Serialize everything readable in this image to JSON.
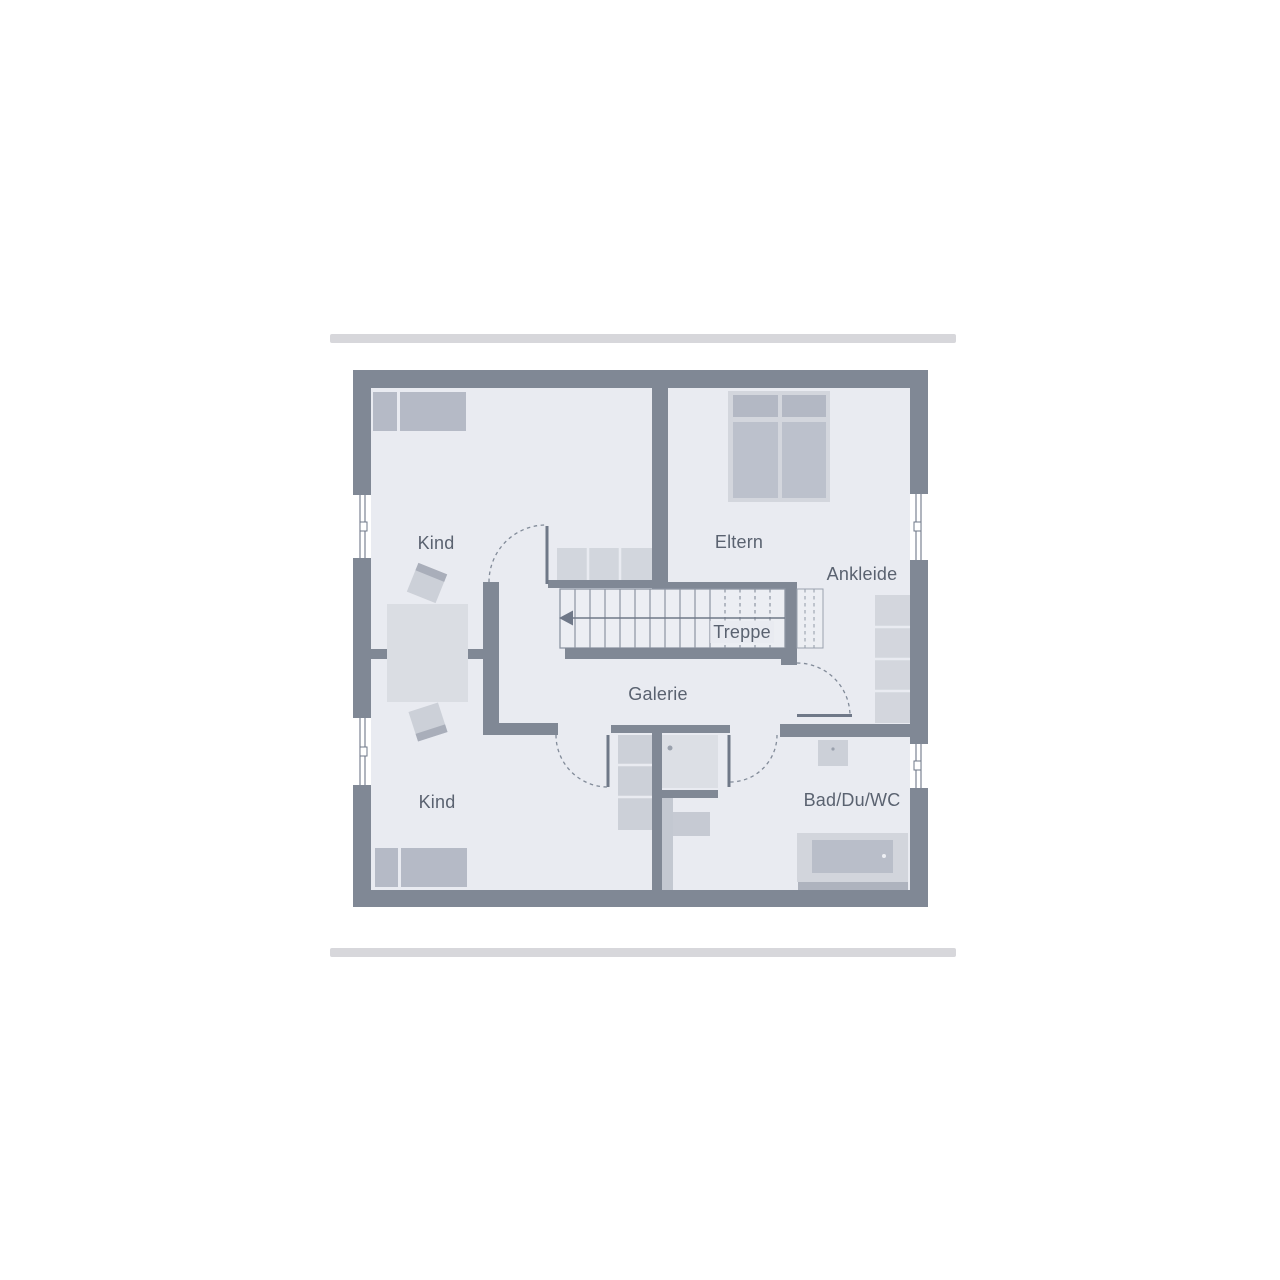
{
  "plan": {
    "type": "floor-plan",
    "floor": "upper-floor",
    "labels": {
      "kind_top": "Kind",
      "eltern": "Eltern",
      "ankleide": "Ankleide",
      "treppe": "Treppe",
      "galerie": "Galerie",
      "kind_bottom": "Kind",
      "bad": "Bad/Du/WC"
    },
    "rooms": [
      {
        "name": "kind-top",
        "label": "Kind"
      },
      {
        "name": "eltern",
        "label": "Eltern"
      },
      {
        "name": "ankleide",
        "label": "Ankleide"
      },
      {
        "name": "treppe",
        "label": "Treppe"
      },
      {
        "name": "galerie",
        "label": "Galerie"
      },
      {
        "name": "kind-bottom",
        "label": "Kind"
      },
      {
        "name": "bad-du-wc",
        "label": "Bad/Du/WC"
      }
    ],
    "colors": {
      "wall": "#808895",
      "floor": "#e9ebf1",
      "furniture_light": "#d3d6dd",
      "furniture_medium": "#b7bcc8",
      "accent_bar": "#d7d7db",
      "label_text": "#5a6270",
      "door_line": "#6f7888"
    }
  }
}
